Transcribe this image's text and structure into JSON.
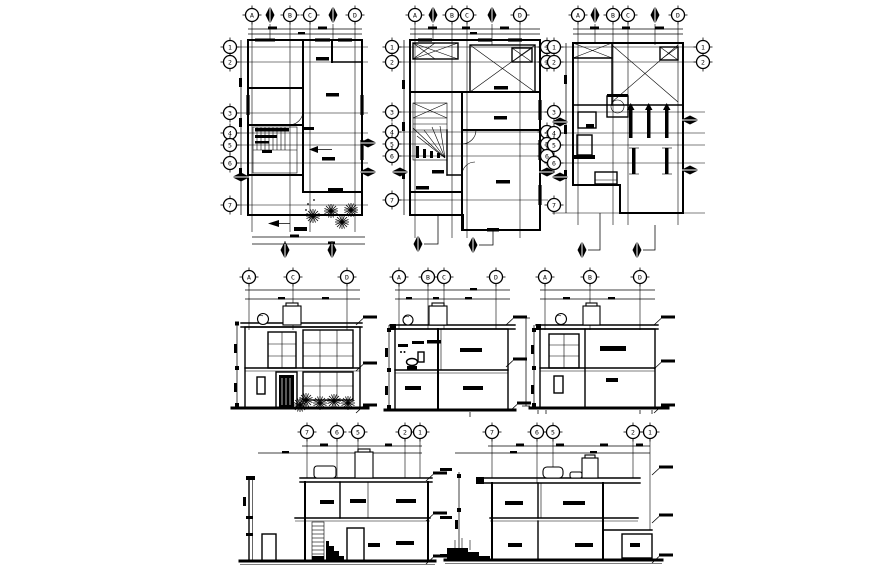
{
  "meta": {
    "drawing_type": "architectural-cad-sheet",
    "background_color": "#ffffff",
    "line_color": "#000000"
  },
  "plans": {
    "ground": {
      "cols": [
        "A",
        "B",
        "C",
        "D"
      ],
      "rows": [
        "1",
        "2",
        "3",
        "4",
        "5",
        "6",
        "7"
      ]
    },
    "first": {
      "cols": [
        "A",
        "B",
        "C",
        "D"
      ],
      "rows_left": [
        "1",
        "2",
        "3",
        "4",
        "5",
        "6",
        "7"
      ],
      "rows_right": [
        "1",
        "2",
        "4",
        "5",
        "6"
      ]
    },
    "roof": {
      "cols": [
        "A",
        "B",
        "C",
        "D"
      ],
      "rows_left": [
        "1",
        "2",
        "3",
        "4",
        "5",
        "6",
        "7"
      ],
      "rows_right": [
        "1",
        "2"
      ]
    }
  },
  "elevations": {
    "front": {
      "cols": [
        "A",
        "C",
        "D"
      ]
    },
    "cross_section": {
      "cols": [
        "A",
        "B",
        "C",
        "D"
      ]
    },
    "side": {
      "cols": [
        "A",
        "B",
        "D"
      ]
    }
  },
  "sections": {
    "long1": {
      "cols": [
        "7",
        "6",
        "5",
        "2",
        "1"
      ]
    },
    "long2": {
      "cols": [
        "7",
        "6",
        "5",
        "2",
        "1"
      ]
    }
  }
}
